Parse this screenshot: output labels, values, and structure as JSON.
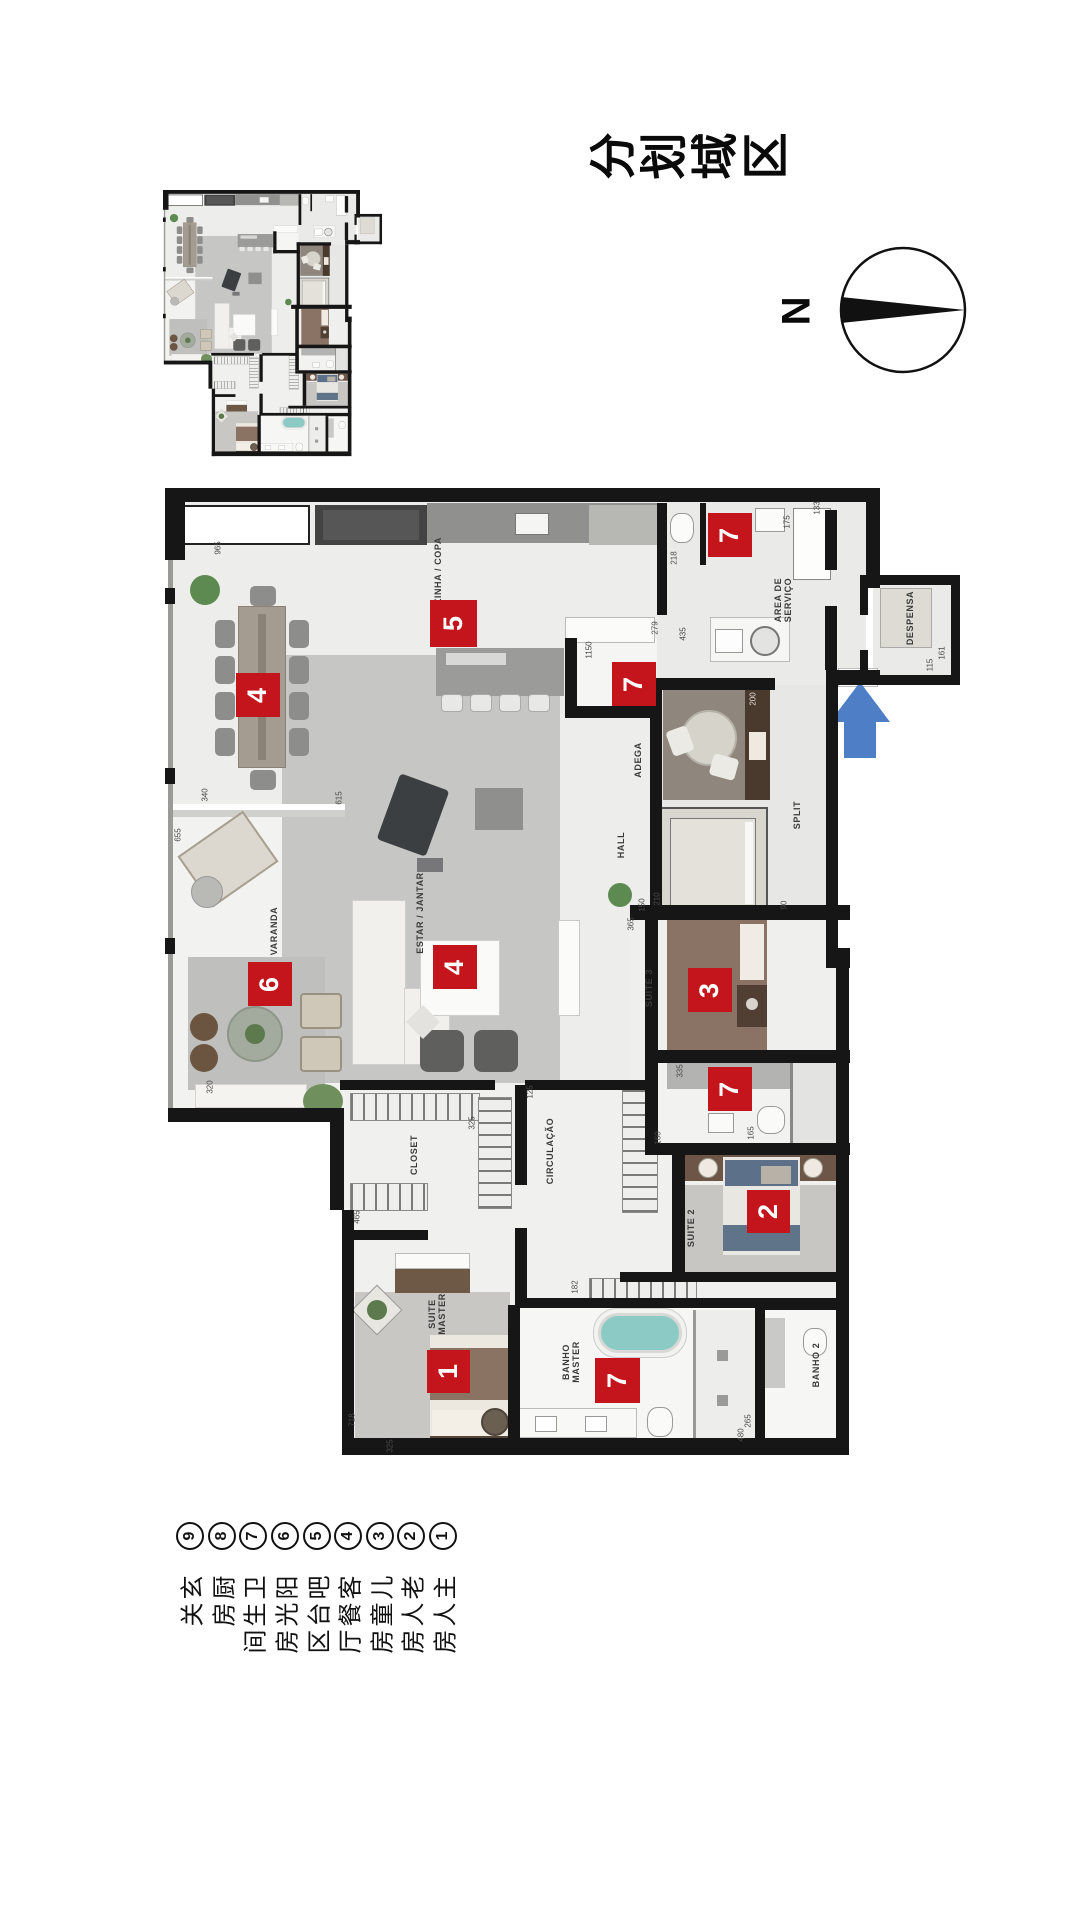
{
  "title": {
    "text": "区域划分"
  },
  "compass": {
    "label": "N"
  },
  "colors": {
    "marker_red": "#c3151b",
    "arrow_blue": "#4d7ec6",
    "wall_black": "#161616"
  },
  "legend": {
    "items": [
      {
        "num": "1",
        "label": "主人房"
      },
      {
        "num": "2",
        "label": "老人房"
      },
      {
        "num": "3",
        "label": "儿童房"
      },
      {
        "num": "4",
        "label": "客餐厅"
      },
      {
        "num": "5",
        "label": "吧台区"
      },
      {
        "num": "6",
        "label": "阳光房"
      },
      {
        "num": "7",
        "label": "卫生间"
      },
      {
        "num": "8",
        "label": "厨房"
      },
      {
        "num": "9",
        "label": "玄关"
      }
    ]
  },
  "markers": [
    {
      "n": "7",
      "x": 543,
      "y": 25
    },
    {
      "n": "5",
      "x": 265,
      "y": 112,
      "s": 47
    },
    {
      "n": "7",
      "x": 447,
      "y": 174
    },
    {
      "n": "4",
      "x": 71,
      "y": 185
    },
    {
      "n": "6",
      "x": 83,
      "y": 474
    },
    {
      "n": "4",
      "x": 268,
      "y": 457
    },
    {
      "n": "3",
      "x": 523,
      "y": 480
    },
    {
      "n": "7",
      "x": 543,
      "y": 579
    },
    {
      "n": "2",
      "x": 582,
      "y": 702,
      "s": 43
    },
    {
      "n": "1",
      "x": 262,
      "y": 862,
      "s": 43
    },
    {
      "n": "7",
      "x": 430,
      "y": 870,
      "s": 45
    }
  ],
  "room_labels": [
    {
      "t": "COZINHA / COPA",
      "x": 273,
      "y": 90
    },
    {
      "lines": [
        "AREA DE",
        "SERVIÇO"
      ],
      "x": 618,
      "y": 112
    },
    {
      "t": "DESPENSA",
      "x": 745,
      "y": 130
    },
    {
      "t": "ADEGA",
      "x": 473,
      "y": 272
    },
    {
      "t": "HALL",
      "x": 456,
      "y": 357
    },
    {
      "t": "SPLIT",
      "x": 632,
      "y": 327
    },
    {
      "t": "SUITE 3",
      "x": 484,
      "y": 500
    },
    {
      "t": "SUITE 2",
      "x": 526,
      "y": 740
    },
    {
      "t": "CIRCULAÇÃO",
      "x": 385,
      "y": 663
    },
    {
      "t": "CLOSET",
      "x": 249,
      "y": 667
    },
    {
      "lines": [
        "SUITE",
        "MASTER"
      ],
      "x": 272,
      "y": 826
    },
    {
      "lines": [
        "BANHO",
        "MASTER"
      ],
      "x": 406,
      "y": 874
    },
    {
      "t": "BANHO 2",
      "x": 651,
      "y": 877
    },
    {
      "t": "VARANDA",
      "x": 109,
      "y": 443
    },
    {
      "t": "ESTAR / JANTAR",
      "x": 255,
      "y": 425
    }
  ],
  "dimensions": [
    {
      "t": "965",
      "x": 53,
      "y": 60
    },
    {
      "t": "218",
      "x": 509,
      "y": 70
    },
    {
      "t": "175",
      "x": 622,
      "y": 34
    },
    {
      "t": "133",
      "x": 652,
      "y": 20
    },
    {
      "t": "435",
      "x": 518,
      "y": 146
    },
    {
      "t": "279",
      "x": 490,
      "y": 140
    },
    {
      "t": "1150",
      "x": 424,
      "y": 162
    },
    {
      "t": "115",
      "x": 765,
      "y": 177
    },
    {
      "t": "161",
      "x": 777,
      "y": 165
    },
    {
      "t": "200",
      "x": 588,
      "y": 211,
      "lt": true
    },
    {
      "t": "365",
      "x": 466,
      "y": 436
    },
    {
      "t": "210",
      "x": 492,
      "y": 411
    },
    {
      "t": "150",
      "x": 477,
      "y": 417
    },
    {
      "t": "90",
      "x": 619,
      "y": 417
    },
    {
      "t": "335",
      "x": 515,
      "y": 583
    },
    {
      "t": "160",
      "x": 493,
      "y": 650
    },
    {
      "t": "165",
      "x": 586,
      "y": 645
    },
    {
      "t": "325",
      "x": 307,
      "y": 635
    },
    {
      "t": "465",
      "x": 192,
      "y": 729
    },
    {
      "t": "125",
      "x": 365,
      "y": 604
    },
    {
      "t": "655",
      "x": 13,
      "y": 347
    },
    {
      "t": "615",
      "x": 174,
      "y": 310
    },
    {
      "t": "340",
      "x": 40,
      "y": 307
    },
    {
      "t": "320",
      "x": 45,
      "y": 599
    },
    {
      "t": "718",
      "x": 187,
      "y": 932
    },
    {
      "t": "325",
      "x": 225,
      "y": 958
    },
    {
      "t": "182",
      "x": 410,
      "y": 799
    },
    {
      "t": "480",
      "x": 576,
      "y": 947
    },
    {
      "t": "265",
      "x": 583,
      "y": 933
    }
  ]
}
